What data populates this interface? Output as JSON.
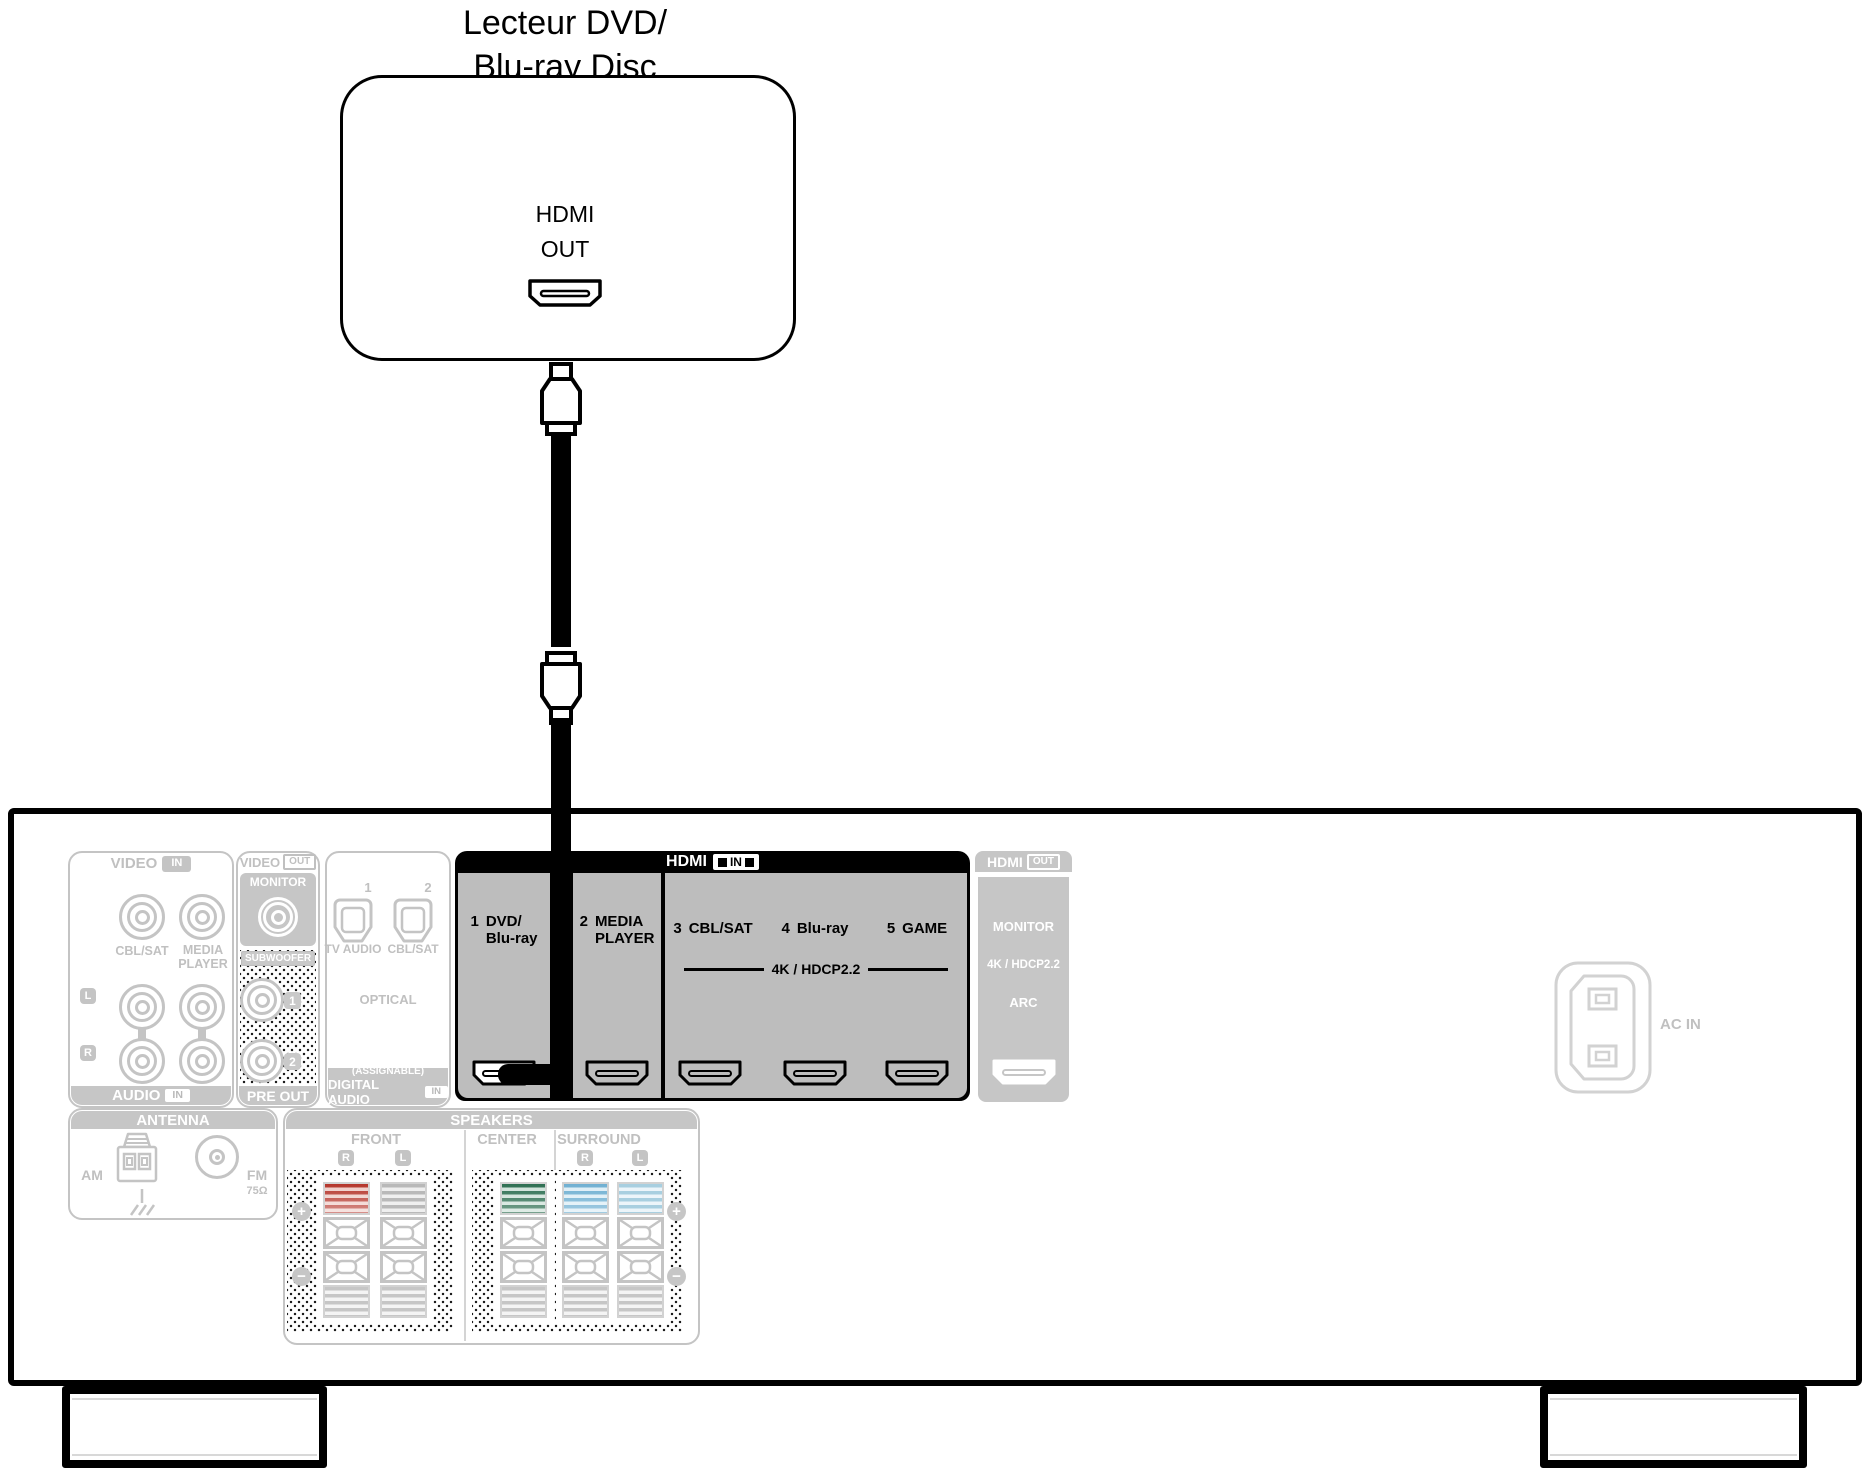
{
  "device": {
    "title": "Lecteur DVD/\nBlu-ray Disc",
    "port_line1": "HDMI",
    "port_line2": "OUT"
  },
  "receiver": {
    "video_audio": {
      "header": "VIDEO",
      "header_badge": "IN",
      "cbl_sat": "CBL/SAT",
      "media_player": "MEDIA\nPLAYER",
      "left": "L",
      "right": "R",
      "footer": "AUDIO",
      "footer_badge": "IN"
    },
    "monitor_out": {
      "header": "VIDEO",
      "header_badge": "OUT",
      "monitor": "MONITOR"
    },
    "pre_out": {
      "subwoofer": "SUBWOOFER",
      "jack1": "1",
      "jack2": "2",
      "footer": "PRE OUT"
    },
    "digital_audio": {
      "num1": "1",
      "num2": "2",
      "tv_audio": "TV AUDIO",
      "cbl_sat": "CBL/SAT",
      "optical": "OPTICAL",
      "assignable": "(ASSIGNABLE)",
      "footer": "DIGITAL AUDIO",
      "footer_badge": "IN"
    },
    "hdmi_in": {
      "header": "HDMI",
      "header_badge": "IN",
      "ports": [
        {
          "num": "1",
          "label": "DVD/\nBlu-ray"
        },
        {
          "num": "2",
          "label": "MEDIA\nPLAYER"
        },
        {
          "num": "3",
          "label": "CBL/SAT"
        },
        {
          "num": "4",
          "label": "Blu-ray"
        },
        {
          "num": "5",
          "label": "GAME"
        }
      ],
      "hdcp": "4K / HDCP2.2"
    },
    "hdmi_out": {
      "header": "HDMI",
      "header_badge": "OUT",
      "monitor": "MONITOR",
      "hdcp": "4K / HDCP2.2",
      "arc": "ARC"
    },
    "antenna": {
      "header": "ANTENNA",
      "am": "AM",
      "fm": "FM",
      "impedance": "75Ω"
    },
    "speakers": {
      "header": "SPEAKERS",
      "front": "FRONT",
      "center": "CENTER",
      "surround": "SURROUND",
      "right": "R",
      "left": "L",
      "plus": "+",
      "minus": "−"
    },
    "ac_in": "AC IN"
  },
  "colors": {
    "front_r": "#b5352b",
    "front_l": "#b9b9b9",
    "center": "#2e6f52",
    "surround_r": "#6fb0d2",
    "surround_l": "#a8cfe0",
    "highlight_gray": "#bdbdbd",
    "muted_gray": "#c4c4c4"
  }
}
